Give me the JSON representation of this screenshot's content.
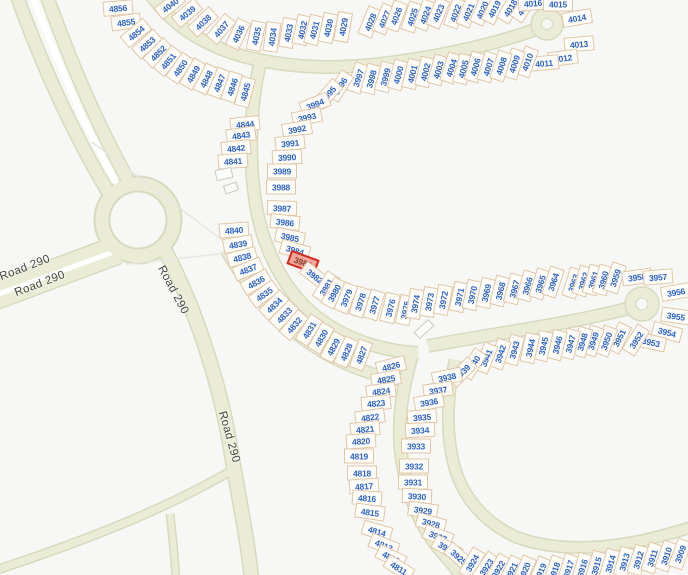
{
  "map": {
    "type": "parcel-map",
    "highlighted_parcel": "3983",
    "colors": {
      "background": "#f7f7f6",
      "road_fill": "#eaecd6",
      "road_edge": "#d8dabd",
      "parcel_stroke": "#cda06e",
      "parcel_number": "#2d63c8",
      "highlight_fill": "#f2a59b",
      "highlight_stroke": "#d42a1e",
      "road_label_color": "#45453f"
    },
    "road_labels": [
      {
        "text": "Road 290",
        "x": 25,
        "y": 268,
        "rot": -21
      },
      {
        "text": "Road 290",
        "x": 40,
        "y": 284,
        "rot": -21
      },
      {
        "text": "Road 290",
        "x": 173,
        "y": 290,
        "rot": 62
      },
      {
        "text": "Road 290",
        "x": 229,
        "y": 437,
        "rot": 74
      }
    ],
    "buildings": [
      {
        "x": 224,
        "y": 174,
        "w": 17,
        "h": 11,
        "rot": -12
      },
      {
        "x": 231,
        "y": 188,
        "w": 14,
        "h": 9,
        "rot": -18
      },
      {
        "x": 424,
        "y": 329,
        "w": 20,
        "h": 9,
        "rot": -42
      }
    ],
    "parcels": [
      [
        "4856",
        118,
        8,
        -5
      ],
      [
        "4855",
        126,
        22,
        -8
      ],
      [
        "4854",
        136,
        33,
        -40
      ],
      [
        "4853",
        147,
        44,
        -42
      ],
      [
        "4852",
        158,
        53,
        -45
      ],
      [
        "4851",
        168,
        61,
        -50
      ],
      [
        "4850",
        180,
        68,
        -55
      ],
      [
        "4849",
        193,
        74,
        -60
      ],
      [
        "4848",
        206,
        79,
        -63
      ],
      [
        "4847",
        219,
        83,
        -68
      ],
      [
        "4846",
        232,
        87,
        -72
      ],
      [
        "4845",
        245,
        92,
        -75
      ],
      [
        "4040",
        170,
        5,
        -38
      ],
      [
        "4039",
        187,
        13,
        -40
      ],
      [
        "4038",
        203,
        22,
        -44
      ],
      [
        "4037",
        221,
        29,
        -50
      ],
      [
        "4036",
        238,
        34,
        -65
      ],
      [
        "4035",
        256,
        36,
        -78
      ],
      [
        "4034",
        272,
        37,
        -82
      ],
      [
        "4033",
        288,
        33,
        -80
      ],
      [
        "4032",
        302,
        30,
        -78
      ],
      [
        "4031",
        314,
        30,
        -76
      ],
      [
        "4030",
        328,
        28,
        -78
      ],
      [
        "4029",
        343,
        27,
        -80
      ],
      [
        "4028",
        370,
        22,
        -68
      ],
      [
        "4027",
        384,
        19,
        -68
      ],
      [
        "4026",
        396,
        16,
        -70
      ],
      [
        "4025",
        412,
        17,
        -72
      ],
      [
        "4024",
        425,
        15,
        -70
      ],
      [
        "4023",
        438,
        13,
        -68
      ],
      [
        "4022",
        455,
        13,
        -70
      ],
      [
        "4021",
        468,
        12,
        -68
      ],
      [
        "4020",
        482,
        10,
        -66
      ],
      [
        "4019",
        494,
        9,
        -63
      ],
      [
        "4018",
        510,
        8,
        -60
      ],
      [
        "4017",
        524,
        7,
        -56
      ],
      [
        "4016",
        533,
        3,
        -5
      ],
      [
        "4015",
        558,
        4,
        0
      ],
      [
        "4014",
        577,
        18,
        -10
      ],
      [
        "4013",
        579,
        44,
        -5
      ],
      [
        "4012",
        563,
        58,
        -8
      ],
      [
        "4011",
        544,
        63,
        -5
      ],
      [
        "4010",
        527,
        62,
        -70
      ],
      [
        "4009",
        514,
        64,
        -72
      ],
      [
        "3997",
        358,
        78,
        -72
      ],
      [
        "3998",
        371,
        79,
        -75
      ],
      [
        "3999",
        385,
        77,
        -75
      ],
      [
        "4000",
        398,
        75,
        -75
      ],
      [
        "4001",
        412,
        74,
        -76
      ],
      [
        "4002",
        425,
        72,
        -76
      ],
      [
        "4003",
        438,
        70,
        -74
      ],
      [
        "4004",
        451,
        68,
        -72
      ],
      [
        "4005",
        463,
        69,
        -75
      ],
      [
        "4006",
        475,
        67,
        -74
      ],
      [
        "4007",
        488,
        67,
        -73
      ],
      [
        "4008",
        501,
        66,
        -72
      ],
      [
        "3996",
        340,
        86,
        -58
      ],
      [
        "3995",
        328,
        94,
        -48
      ],
      [
        "3994",
        315,
        104,
        -22
      ],
      [
        "3993",
        307,
        117,
        -12
      ],
      [
        "3992",
        297,
        129,
        -10
      ],
      [
        "3991",
        290,
        143,
        -6
      ],
      [
        "3990",
        287,
        157,
        -3
      ],
      [
        "3989",
        282,
        171,
        0
      ],
      [
        "3988",
        281,
        187,
        0
      ],
      [
        "3987",
        282,
        208,
        2
      ],
      [
        "3986",
        285,
        222,
        6
      ],
      [
        "3985",
        290,
        237,
        12
      ],
      [
        "3984",
        295,
        250,
        16
      ],
      [
        "3983",
        303,
        262,
        20,
        "hl"
      ],
      [
        "3982",
        315,
        276,
        38
      ],
      [
        "3981",
        326,
        287,
        -58
      ],
      [
        "3980",
        334,
        293,
        -62
      ],
      [
        "3979",
        346,
        298,
        -68
      ],
      [
        "3978",
        360,
        302,
        -72
      ],
      [
        "3977",
        374,
        305,
        -73
      ],
      [
        "3976",
        390,
        308,
        -76
      ],
      [
        "3975",
        405,
        310,
        -78
      ],
      [
        "3974",
        415,
        304,
        -80
      ],
      [
        "3973",
        429,
        302,
        -80
      ],
      [
        "3972",
        443,
        300,
        -79
      ],
      [
        "3971",
        459,
        297,
        -78
      ],
      [
        "3970",
        472,
        295,
        -78
      ],
      [
        "3969",
        486,
        293,
        -77
      ],
      [
        "3968",
        500,
        291,
        -76
      ],
      [
        "3967",
        514,
        289,
        -75
      ],
      [
        "3966",
        527,
        286,
        -74
      ],
      [
        "3965",
        540,
        284,
        -73
      ],
      [
        "3964",
        553,
        282,
        -72
      ],
      [
        "3963",
        573,
        283,
        -72
      ],
      [
        "3962",
        583,
        281,
        -73
      ],
      [
        "3961",
        593,
        280,
        -74
      ],
      [
        "3960",
        603,
        280,
        -75
      ],
      [
        "3959",
        615,
        278,
        -72
      ],
      [
        "3958",
        637,
        277,
        -8
      ],
      [
        "3957",
        658,
        277,
        -5
      ],
      [
        "3956",
        676,
        292,
        -10
      ],
      [
        "3955",
        676,
        316,
        8
      ],
      [
        "3954",
        667,
        332,
        15
      ],
      [
        "3953",
        651,
        342,
        12
      ],
      [
        "3952",
        636,
        340,
        -58
      ],
      [
        "3951",
        619,
        338,
        -64
      ],
      [
        "3950",
        606,
        341,
        -70
      ],
      [
        "3949",
        593,
        341,
        -72
      ],
      [
        "3948",
        582,
        342,
        -74
      ],
      [
        "3947",
        570,
        344,
        -75
      ],
      [
        "3946",
        557,
        345,
        -76
      ],
      [
        "3945",
        543,
        346,
        -77
      ],
      [
        "3944",
        530,
        348,
        -78
      ],
      [
        "3943",
        514,
        350,
        -75
      ],
      [
        "3942",
        500,
        354,
        -72
      ],
      [
        "3941",
        486,
        358,
        -68
      ],
      [
        "3940",
        473,
        364,
        -58
      ],
      [
        "3939",
        462,
        372,
        -45
      ],
      [
        "3938",
        447,
        377,
        -12
      ],
      [
        "3937",
        438,
        390,
        -8
      ],
      [
        "3936",
        429,
        402,
        -10
      ],
      [
        "3935",
        422,
        417,
        -5
      ],
      [
        "3934",
        420,
        430,
        -3
      ],
      [
        "3933",
        416,
        446,
        0
      ],
      [
        "3932",
        414,
        466,
        0
      ],
      [
        "3931",
        413,
        482,
        0
      ],
      [
        "3930",
        417,
        496,
        3
      ],
      [
        "3929",
        423,
        510,
        8
      ],
      [
        "3928",
        431,
        523,
        15
      ],
      [
        "3927",
        438,
        536,
        20
      ],
      [
        "3926",
        447,
        548,
        30
      ],
      [
        "3925",
        459,
        557,
        42
      ],
      [
        "3924",
        472,
        563,
        -60
      ],
      [
        "3923",
        486,
        567,
        -56
      ],
      [
        "3922",
        498,
        569,
        -60
      ],
      [
        "3921",
        511,
        571,
        -63
      ],
      [
        "3920",
        524,
        571,
        -66
      ],
      [
        "3919",
        540,
        572,
        -68
      ],
      [
        "3918",
        554,
        571,
        -70
      ],
      [
        "3917",
        568,
        569,
        -72
      ],
      [
        "3916",
        582,
        568,
        -73
      ],
      [
        "3915",
        596,
        566,
        -74
      ],
      [
        "3914",
        610,
        564,
        -74
      ],
      [
        "3913",
        624,
        562,
        -74
      ],
      [
        "3912",
        638,
        560,
        -73
      ],
      [
        "3911",
        652,
        558,
        -72
      ],
      [
        "3910",
        666,
        556,
        -71
      ],
      [
        "3909",
        680,
        554,
        -70
      ],
      [
        "4844",
        245,
        124,
        -6
      ],
      [
        "4843",
        241,
        135,
        -8
      ],
      [
        "4842",
        236,
        148,
        -6
      ],
      [
        "4841",
        233,
        161,
        -4
      ],
      [
        "4840",
        234,
        230,
        -4
      ],
      [
        "4839",
        238,
        244,
        -10
      ],
      [
        "4838",
        242,
        257,
        -14
      ],
      [
        "4837",
        248,
        269,
        -22
      ],
      [
        "4836",
        256,
        282,
        -30
      ],
      [
        "4835",
        264,
        294,
        -36
      ],
      [
        "4834",
        274,
        305,
        -44
      ],
      [
        "4833",
        284,
        315,
        -46
      ],
      [
        "4832",
        294,
        325,
        -50
      ],
      [
        "4831",
        309,
        330,
        -58
      ],
      [
        "4830",
        321,
        338,
        -60
      ],
      [
        "4829",
        333,
        347,
        -62
      ],
      [
        "4828",
        346,
        352,
        -66
      ],
      [
        "4827",
        361,
        355,
        -70
      ],
      [
        "4826",
        391,
        366,
        -14
      ],
      [
        "4825",
        386,
        379,
        -10
      ],
      [
        "4824",
        381,
        391,
        -8
      ],
      [
        "4823",
        376,
        403,
        -6
      ],
      [
        "4822",
        370,
        417,
        -8
      ],
      [
        "4821",
        365,
        429,
        -6
      ],
      [
        "4820",
        361,
        441,
        -4
      ],
      [
        "4819",
        359,
        456,
        0
      ],
      [
        "4818",
        362,
        473,
        0
      ],
      [
        "4817",
        364,
        486,
        -4
      ],
      [
        "4816",
        367,
        498,
        4
      ],
      [
        "4815",
        370,
        512,
        8
      ],
      [
        "4814",
        377,
        531,
        16
      ],
      [
        "4813",
        384,
        545,
        22
      ],
      [
        "4812",
        391,
        557,
        26
      ],
      [
        "4811",
        399,
        568,
        32
      ]
    ]
  }
}
